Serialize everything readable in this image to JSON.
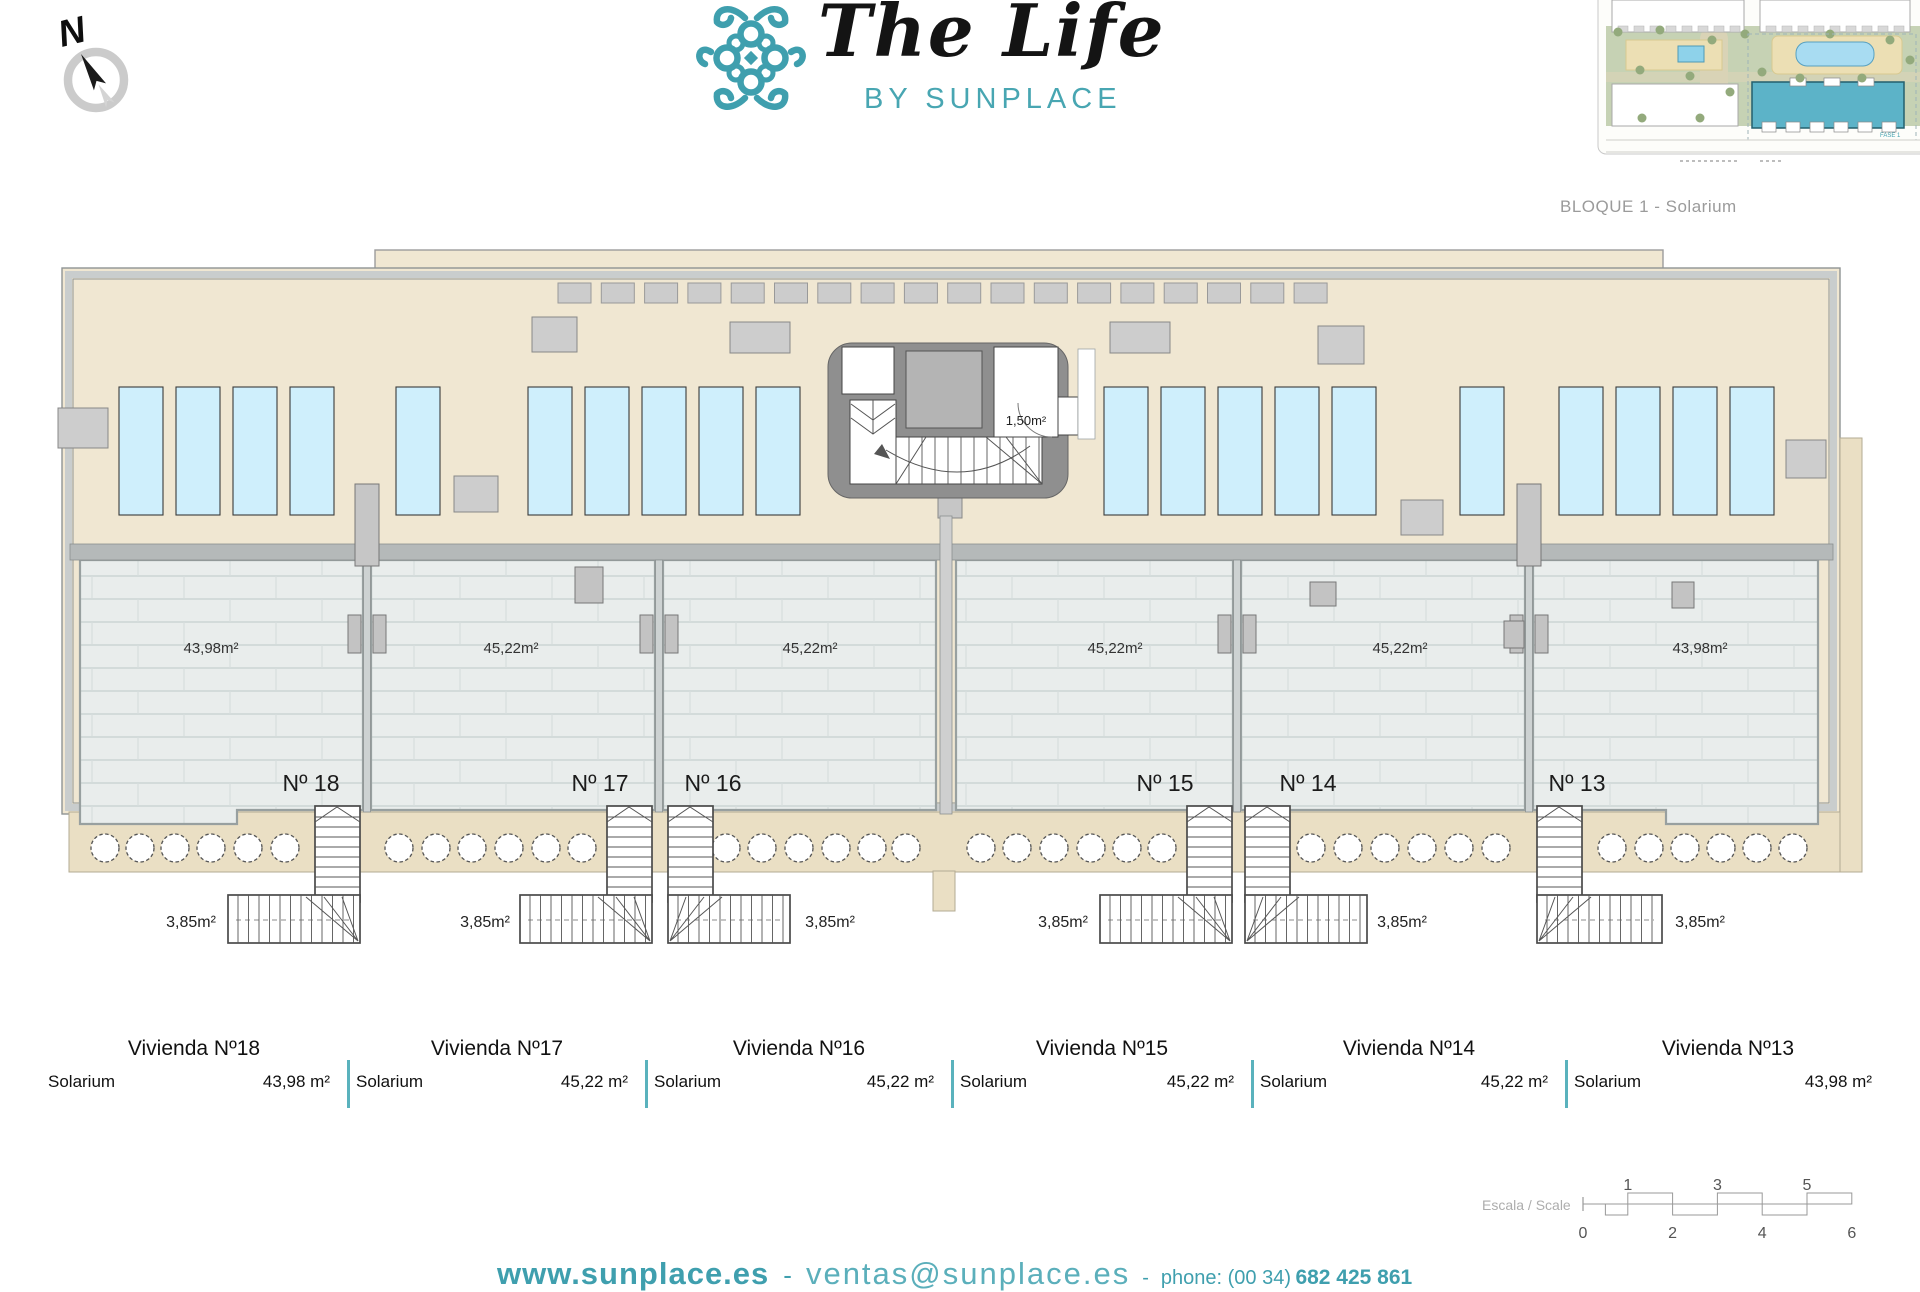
{
  "header": {
    "compass_label": "N",
    "logo_title": "The Life",
    "logo_subtitle": "BY SUNPLACE",
    "sitemap_caption": "BLOQUE 1 - Solarium",
    "sitemap_tag": "FASE 1"
  },
  "plan": {
    "core_label": "1,50m²",
    "units": [
      {
        "number": "Nº 18",
        "area": "43,98m²",
        "stair_area": "3,85m²"
      },
      {
        "number": "Nº 17",
        "area": "45,22m²",
        "stair_area": "3,85m²"
      },
      {
        "number": "Nº 16",
        "area": "45,22m²",
        "stair_area": "3,85m²"
      },
      {
        "number": "Nº 15",
        "area": "45,22m²",
        "stair_area": "3,85m²"
      },
      {
        "number": "Nº 14",
        "area": "45,22m²",
        "stair_area": "3,85m²"
      },
      {
        "number": "Nº 13",
        "area": "43,98m²",
        "stair_area": "3,85m²"
      }
    ]
  },
  "summary_table": {
    "columns": [
      {
        "title": "Vivienda Nº18",
        "row_label": "Solarium",
        "value": "43,98 m²"
      },
      {
        "title": "Vivienda Nº17",
        "row_label": "Solarium",
        "value": "45,22 m²"
      },
      {
        "title": "Vivienda Nº16",
        "row_label": "Solarium",
        "value": "45,22 m²"
      },
      {
        "title": "Vivienda Nº15",
        "row_label": "Solarium",
        "value": "45,22 m²"
      },
      {
        "title": "Vivienda Nº14",
        "row_label": "Solarium",
        "value": "45,22 m²"
      },
      {
        "title": "Vivienda Nº13",
        "row_label": "Solarium",
        "value": "43,98 m²"
      }
    ]
  },
  "scale_bar": {
    "label": "Escala / Scale",
    "top_numbers": [
      "1",
      "3",
      "5"
    ],
    "bottom_numbers": [
      "0",
      "2",
      "4",
      "6"
    ]
  },
  "footer": {
    "website": "www.sunplace.es",
    "sep1": "-",
    "email": "ventas@sunplace.es",
    "sep2": "-",
    "phone_label": "phone: (00 34)",
    "phone_number": "682 425 861"
  },
  "colors": {
    "teal": "#3f9fae",
    "beige_roof": "#f0e7d2",
    "beige_walkway": "#eadfc4",
    "tile": "#e9edec",
    "panel_blue": "#cfeffc",
    "wall_gray": "#b5b9b9",
    "core_gray": "#8f8f8f"
  }
}
